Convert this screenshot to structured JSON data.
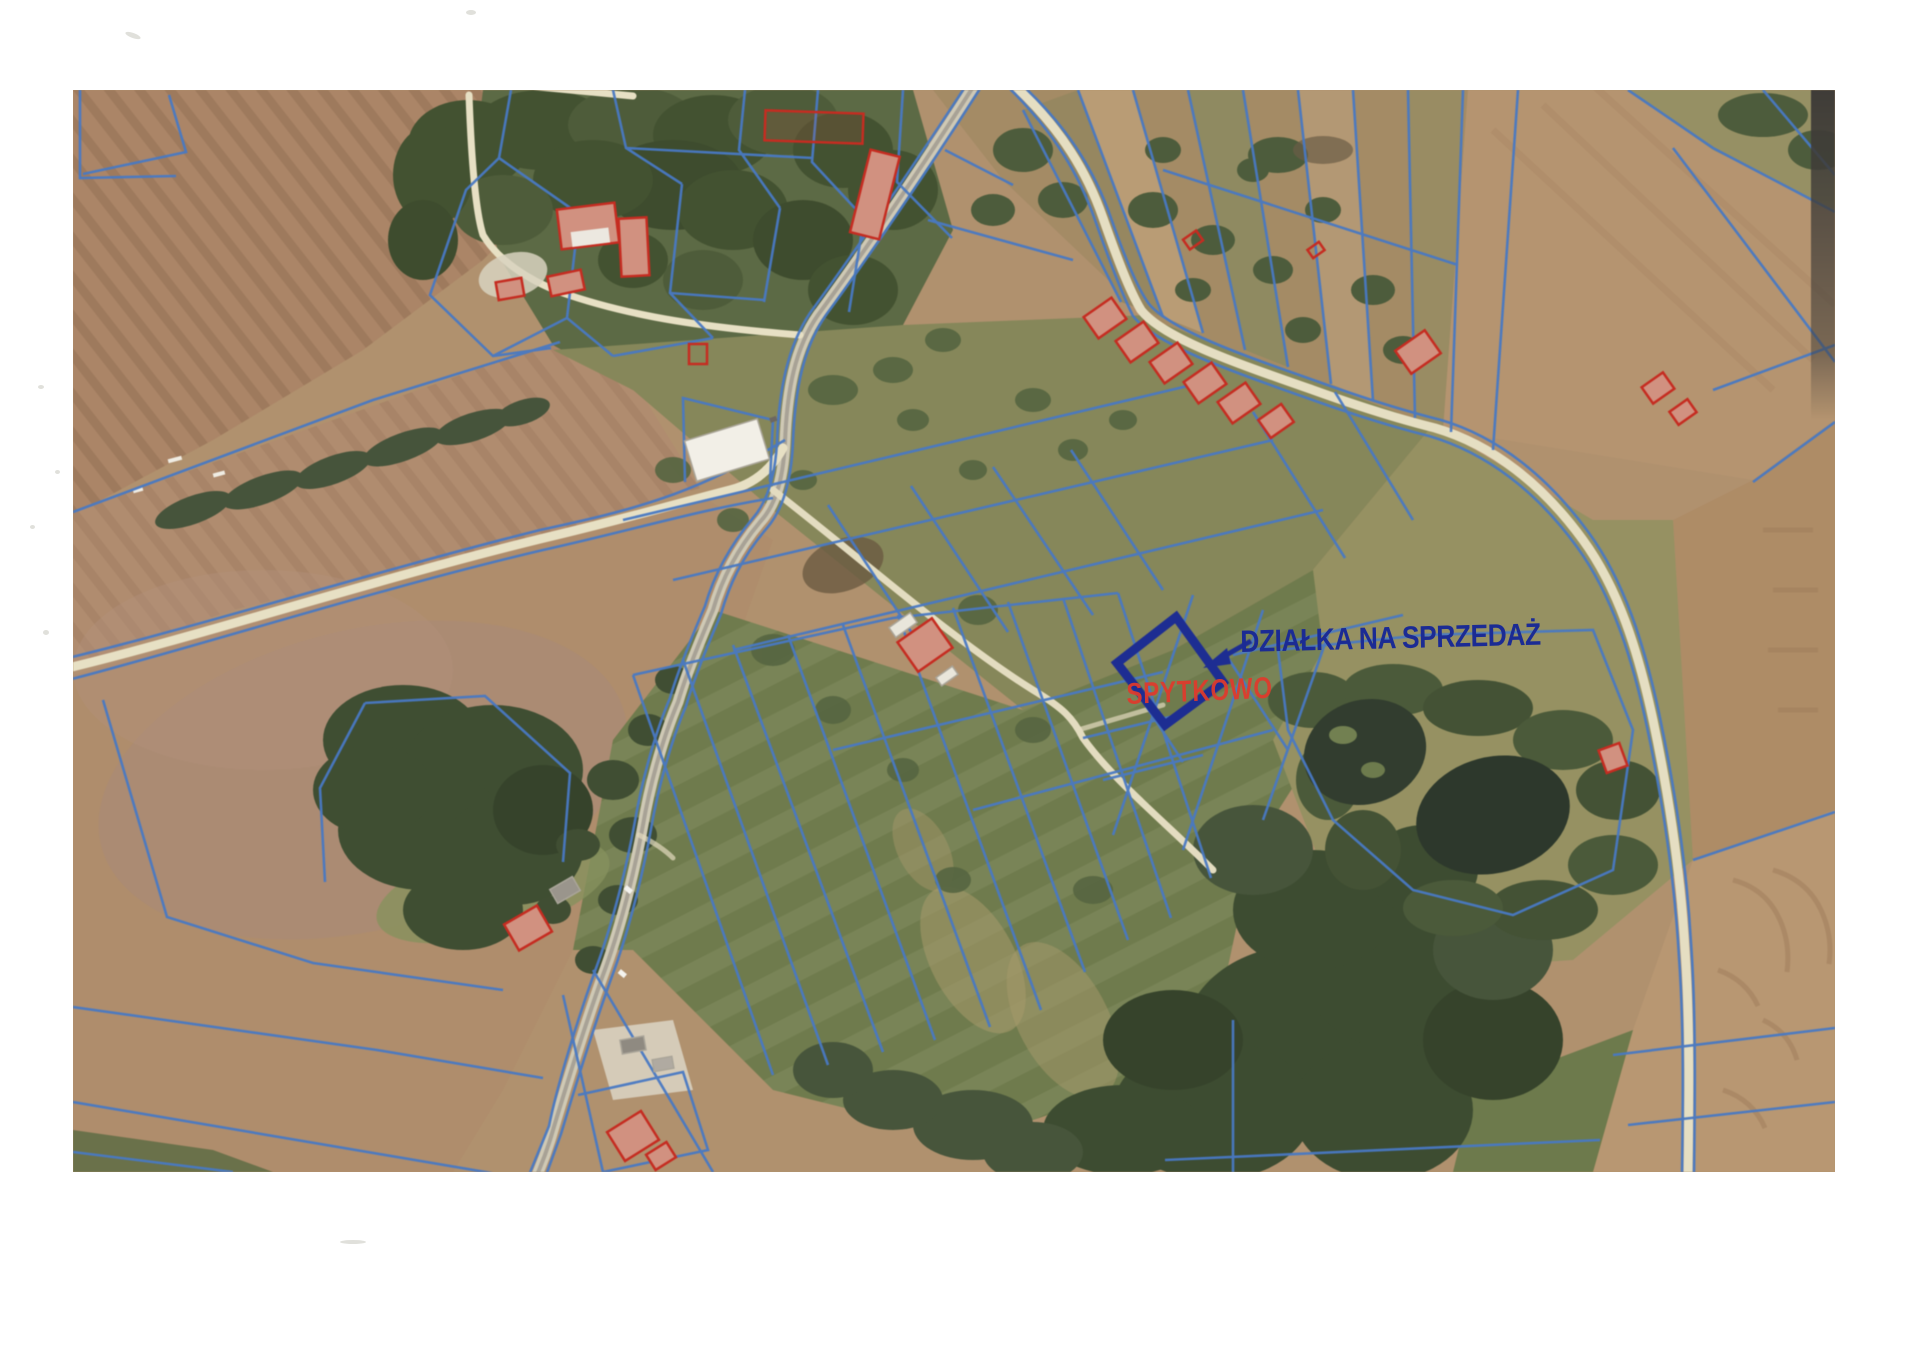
{
  "page": {
    "background_color": "#ffffff"
  },
  "photo": {
    "annotations": {
      "sale_label": {
        "text": "DZIAŁKA NA SPRZEDAŻ",
        "color": "#1b2b94"
      },
      "place_label": {
        "text": "SPYTKOWO",
        "color": "#e03a2c"
      },
      "arrow_icon": "arrow-pointing-to-parcel",
      "highlighted_parcel": {
        "shape": "rotated-rectangle",
        "outline_color": "#1c2d98"
      }
    },
    "map_colors": {
      "parcel_boundary_blue": "#4679c8",
      "building_outline_red": "#cd2a1e",
      "field_tan": "#b2916c",
      "meadow_green": "#6f7b4a",
      "forest_green": "#3e4e31",
      "road_cream": "#e6dec0",
      "pond_dark": "#2c382b"
    }
  }
}
